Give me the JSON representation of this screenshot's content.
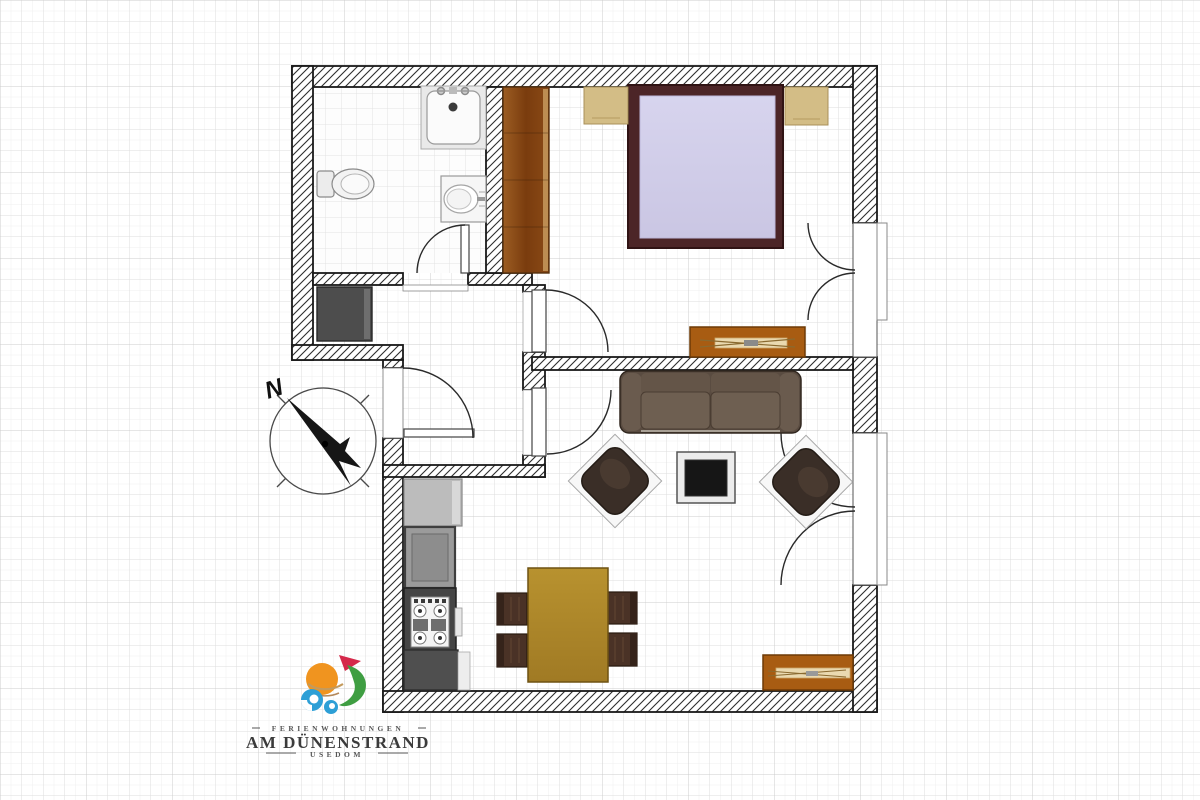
{
  "document": {
    "type": "apartment-floor-plan",
    "background": "graph-paper-grid",
    "orientation_note": "north arrow points upper-left"
  },
  "branding": {
    "tagline_top": "FERIENWOHNUNGEN",
    "name": "AM DÜNENSTRAND",
    "tagline_bottom": "USEDOM",
    "logo_colors": {
      "sun": "#f0941f",
      "bird": "#d5294a",
      "leaf": "#3f9e42",
      "wave": "#2d9fd6",
      "sand": "#c49a5c"
    },
    "text_color": "#3b3b3b"
  },
  "compass": {
    "north_label": "N"
  },
  "palette": {
    "wall_outline": "#1a1a1a",
    "wall_hatch": "#2e2e2e",
    "grid_minor": "#efefef",
    "grid_medium": "#dedede",
    "grid_major": "#cccccc",
    "wardrobe_wood": "#8a4a16",
    "bed_frame": "#4c2527",
    "mattress": "#d2cfe9",
    "nightstand": "#d3bd86",
    "sideboard": "#a85c12",
    "sofa": "#5a4c41",
    "armchair": "#3a2e27",
    "coffee_table_top": "#161616",
    "dining_table": "#b08a2e",
    "dining_chair": "#4a3226",
    "counter_light": "#bcbcbc",
    "counter_mid": "#9b9b9b",
    "counter_dark": "#4f4f4f",
    "stove_body": "#454545",
    "hall_closet": "#4d4d4d"
  },
  "rooms": [
    {
      "name": "bathroom",
      "items": [
        "shower",
        "toilet",
        "washbasin",
        "door"
      ]
    },
    {
      "name": "hallway",
      "items": [
        "entrance-door",
        "closet"
      ]
    },
    {
      "name": "bedroom",
      "items": [
        "wardrobe",
        "double-bed",
        "nightstand-left",
        "nightstand-right",
        "tv-lowboard",
        "french-window",
        "door"
      ]
    },
    {
      "name": "living-room",
      "items": [
        "sofa",
        "armchair-left",
        "armchair-right",
        "coffee-table",
        "sideboard",
        "balcony-door",
        "door"
      ]
    },
    {
      "name": "kitchen-dining",
      "items": [
        "tall-cabinet",
        "sink-cabinet",
        "stove",
        "base-counter",
        "dining-table",
        "chair",
        "chair",
        "chair",
        "chair"
      ]
    }
  ]
}
